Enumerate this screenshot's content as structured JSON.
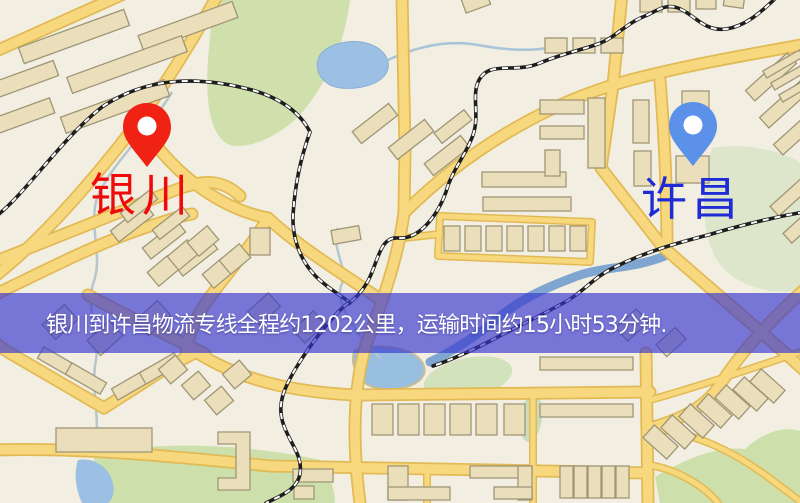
{
  "banner": {
    "text": "银川到许昌物流专线全程约1202公里，运输时间约15小时53分钟."
  },
  "route": {
    "origin": "银川",
    "destination": "许昌",
    "distance_text": "约1202公里",
    "duration_text": "约15小时53分钟"
  },
  "markers": {
    "origin": {
      "label": "银川",
      "pin_color": "#ef2214",
      "label_color": "#ee0a0a"
    },
    "destination": {
      "label": "许昌",
      "pin_color": "#5b91e8",
      "label_color": "#1f2cd6"
    }
  },
  "map_colors": {
    "background": "#f2eee1",
    "road_fill": "#f8d87e",
    "road_casing": "#e2ba55",
    "building": "#eadfba",
    "park_green": "#cfe0ad",
    "water_blue": "#9cc0e4",
    "railway": "#1e1e1e",
    "banner_overlay": "rgba(54,54,206,0.66)"
  }
}
